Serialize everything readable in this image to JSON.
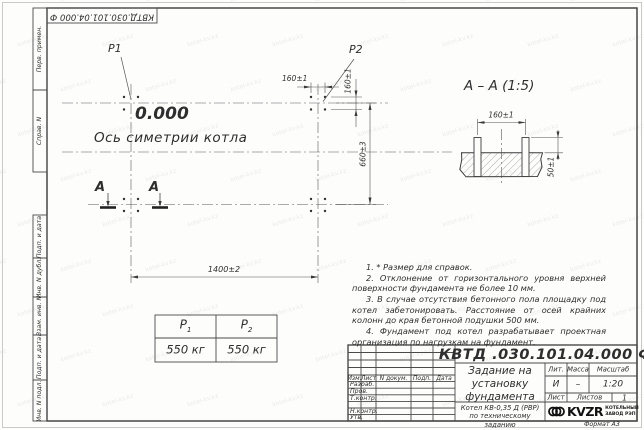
{
  "watermark": {
    "text": "kotel-kv.kz"
  },
  "frame": {
    "doc_number_top": "КВТД.030.101.04.000 Ф",
    "margin_labels": [
      "Перв. примен.",
      "Справ. N",
      "Подп. и дата",
      "Инв. N дубл.",
      "Взам. инв. N",
      "Подп. и дата",
      "Инв. N подл."
    ],
    "format_label": "Формат А3"
  },
  "plan": {
    "load_point_1": "P1",
    "load_point_2": "P2",
    "elevation": "0.000",
    "symmetry_axis_label": "Ось симетрии котла",
    "section_letter_left": "А",
    "section_letter_right": "А",
    "dim_bolt_spacing_h": "160±1",
    "dim_bolt_spacing_v": "160±1",
    "dim_width": "660±3",
    "dim_length": "1400±2"
  },
  "section_view": {
    "title": "А – А (1:5)",
    "dim_bolt_spacing": "160±1",
    "dim_bolt_height": "50±1"
  },
  "load_table": {
    "col1": {
      "symbol": "P",
      "sub": "1",
      "value": "550 кг"
    },
    "col2": {
      "symbol": "P",
      "sub": "2",
      "value": "550 кг"
    }
  },
  "notes": {
    "items": [
      "1. * Размер для справок.",
      "2. Отклонение от горизонтального уровня верхней поверхности фундамента не более 10 мм.",
      "3. В случае отсутствия бетонного пола площадку под котел забетонировать. Расстояние от осей крайних колонн до края бетонной подушки 500 мм.",
      "4. Фундамент под котел разрабатывает проектная организация по нагрузкам на фундамент."
    ]
  },
  "title_block": {
    "doc_number": "КВТД .030.101.04.000  Ф",
    "title": "Задание на установку фундамента",
    "product": "Котел КВ-0,35 Д (РВР) по техническому заданию",
    "columns": [
      "Изм.",
      "Лист",
      "N докум.",
      "Подп.",
      "Дата"
    ],
    "rows": [
      "Разраб.",
      "Пров.",
      "Т.контр.",
      "Н.контр.",
      "Утв."
    ],
    "lit_header": "Лит.",
    "mass_header": "Масса",
    "scale_header": "Масштаб",
    "lit_value": "И",
    "mass_value": "–",
    "scale_value": "1:20",
    "sheet_header": "Лист",
    "sheets_header": "Листов",
    "sheets_value": "1",
    "logo": {
      "name": "KVZR",
      "tagline1": "КОТЕЛЬНЫЙ",
      "tagline2": "ЗАВОД РЭП"
    }
  }
}
